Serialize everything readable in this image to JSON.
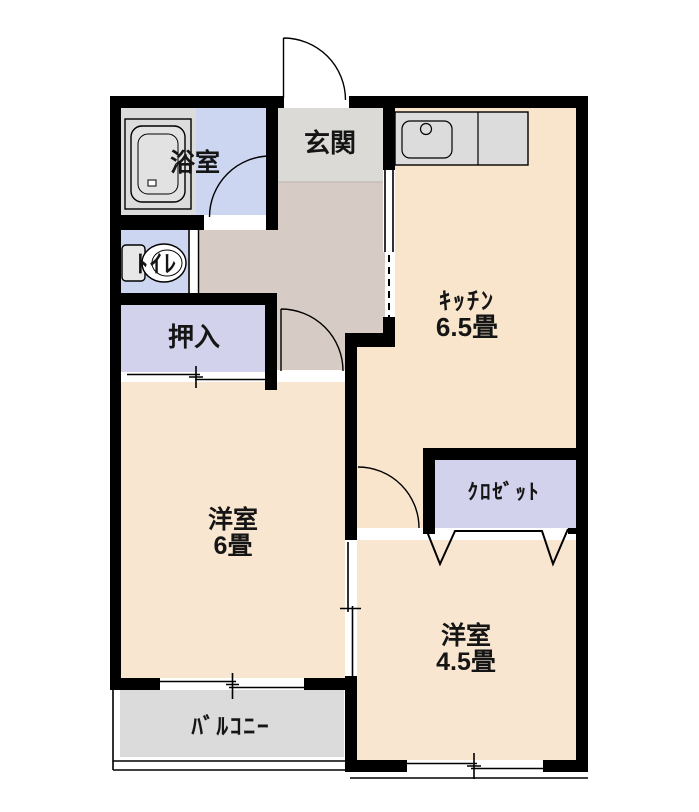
{
  "rooms": {
    "bath": {
      "label": "浴室",
      "color": "#dcdcdc"
    },
    "washroom": {
      "color": "#ccd6f0"
    },
    "entrance": {
      "label": "玄関",
      "color": "#dcdad7"
    },
    "hallway": {
      "color": "#d6ccc5"
    },
    "kitchen": {
      "label": "ｷｯﾁﾝ",
      "size": "6.5畳",
      "color": "#f8e5cb"
    },
    "toilet": {
      "label": "ﾄｲﾚ",
      "color": "#ccd6f0"
    },
    "oshiire": {
      "label": "押入",
      "color": "#d3d2ec"
    },
    "western6": {
      "label": "洋室",
      "size": "6畳",
      "color": "#f8e6d0"
    },
    "closet": {
      "label": "ｸﾛｾﾞｯﾄ",
      "color": "#d3d2ec"
    },
    "western45": {
      "label": "洋室",
      "size": "4.5畳",
      "color": "#f8e6d0"
    },
    "balcony": {
      "label": "ﾊﾞﾙｺﾆｰ",
      "color": "#dbdbdb"
    }
  },
  "colors": {
    "wall": "#000000",
    "fixture_gray": "#dcdcdc",
    "tub_inner": "#e2e2e2"
  }
}
